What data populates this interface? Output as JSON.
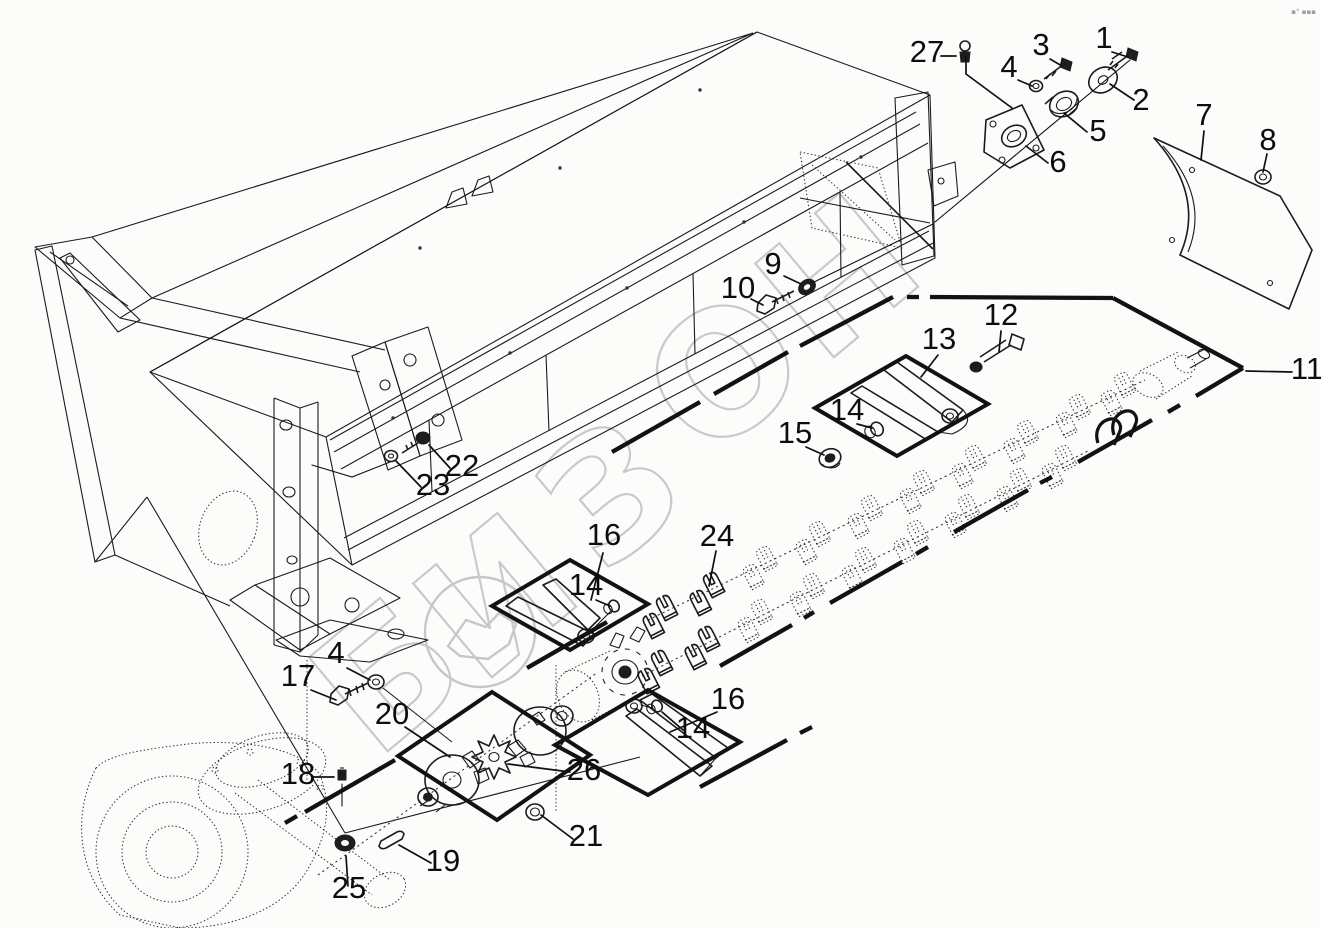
{
  "figure": {
    "type": "exploded-parts-diagram",
    "description_visible_content": "technical exploded view of mower housing with knife shaft, couplings and fasteners",
    "background_color": "#fcfcfb",
    "line_color": "#1b1b1b"
  },
  "watermark": {
    "text": "БИЗОН",
    "letters": [
      "Б",
      "И",
      "З",
      "О",
      "Н"
    ],
    "color": "#c9c9c9",
    "emblem": "bison-circle-logo"
  },
  "corner_mark": {
    "text": "▪° ▪▪▪"
  },
  "callouts": [
    {
      "num": "1",
      "x": 1104,
      "y": 48
    },
    {
      "num": "2",
      "x": 1141,
      "y": 110
    },
    {
      "num": "3",
      "x": 1041,
      "y": 55
    },
    {
      "num": "4",
      "x": 1009,
      "y": 77
    },
    {
      "num": "5",
      "x": 1098,
      "y": 141
    },
    {
      "num": "6",
      "x": 1058,
      "y": 172
    },
    {
      "num": "7",
      "x": 1204,
      "y": 125
    },
    {
      "num": "8",
      "x": 1268,
      "y": 150
    },
    {
      "num": "27",
      "x": 927,
      "y": 62
    },
    {
      "num": "9",
      "x": 773,
      "y": 274
    },
    {
      "num": "10",
      "x": 738,
      "y": 298
    },
    {
      "num": "11",
      "x": 1307,
      "y": 379
    },
    {
      "num": "12",
      "x": 1001,
      "y": 325
    },
    {
      "num": "13",
      "x": 939,
      "y": 349
    },
    {
      "num": "14",
      "x": 847,
      "y": 420
    },
    {
      "num": "15",
      "x": 795,
      "y": 443
    },
    {
      "num": "16",
      "x": 604,
      "y": 545
    },
    {
      "num": "14",
      "x": 586,
      "y": 595
    },
    {
      "num": "24",
      "x": 717,
      "y": 546
    },
    {
      "num": "16",
      "x": 728,
      "y": 709
    },
    {
      "num": "14",
      "x": 693,
      "y": 738
    },
    {
      "num": "17",
      "x": 298,
      "y": 686
    },
    {
      "num": "4",
      "x": 336,
      "y": 663
    },
    {
      "num": "20",
      "x": 392,
      "y": 724
    },
    {
      "num": "26",
      "x": 584,
      "y": 780
    },
    {
      "num": "21",
      "x": 586,
      "y": 846
    },
    {
      "num": "18",
      "x": 298,
      "y": 784
    },
    {
      "num": "25",
      "x": 349,
      "y": 898
    },
    {
      "num": "19",
      "x": 443,
      "y": 871
    },
    {
      "num": "22",
      "x": 462,
      "y": 476
    },
    {
      "num": "23",
      "x": 433,
      "y": 495
    }
  ]
}
